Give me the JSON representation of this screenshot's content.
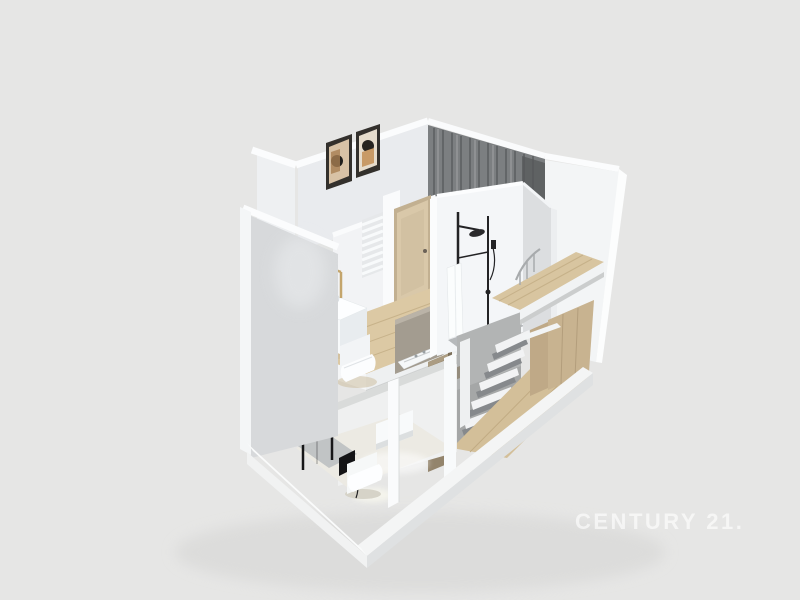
{
  "watermark": {
    "label": "CENTURY 21."
  },
  "palette": {
    "background": "#e6e6e5",
    "wall_white_lit": "#f4f6f8",
    "wall_white_outer": "#fbfcfd",
    "wall_shadow_gray": "#d7d9db",
    "curtain_gray": "#7c7f81",
    "wood_counter": "#d8c5a0",
    "wood_floor": "#d3bf99",
    "wardrobe_wood": "#c8b390",
    "door_beige": "#d9c8a9",
    "fixture_black": "#1c1c1e",
    "faucet_gold": "#c4a56c",
    "shower_tray_gray": "#b6b9bb",
    "ceramic_white": "#f8fafb",
    "watermark_color": "#efefef"
  },
  "scene": {
    "type": "3d-cutaway-floorplan-render",
    "levels": [
      {
        "name": "upper-level",
        "rooms": [
          {
            "name": "bedroom",
            "features": [
              "framed-artwork-pair",
              "dark-gray-curtains"
            ]
          },
          {
            "name": "bathroom",
            "features": [
              "vessel-sink-gold-faucet",
              "wall-hung-toilet",
              "towel-radiator",
              "wood-door",
              "black-shower-column",
              "gray-divider-panel",
              "decorative-white-boat"
            ]
          },
          {
            "name": "loft-landing",
            "features": [
              "wood-counter-floor",
              "stair-railing"
            ]
          }
        ]
      },
      {
        "name": "lower-level",
        "rooms": [
          {
            "name": "shower-room",
            "features": [
              "black-framed-shower",
              "wall-sink-black-tap",
              "toilet-with-black-sprayer"
            ]
          },
          {
            "name": "hall",
            "features": [
              "curved-staircase",
              "wood-floor",
              "wood-wardrobe"
            ]
          }
        ]
      }
    ]
  }
}
